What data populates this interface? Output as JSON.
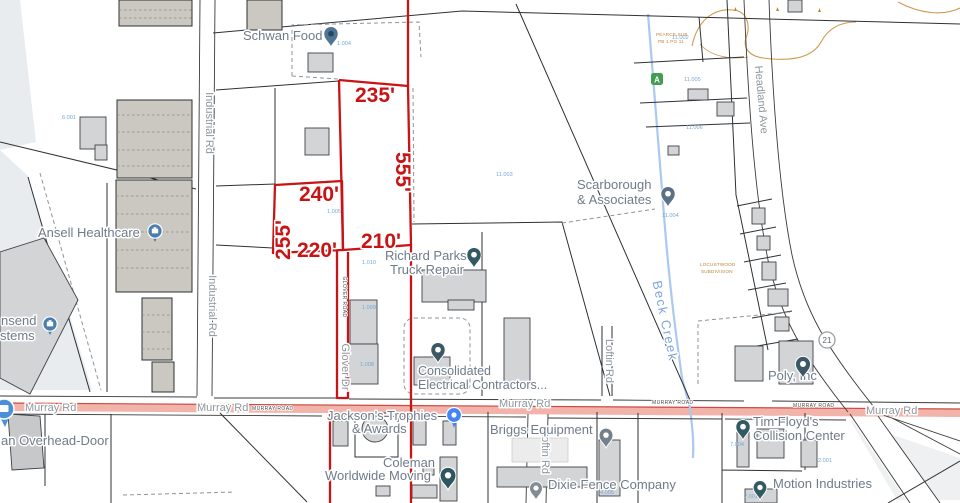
{
  "colors": {
    "survey_red": "#c81414",
    "road_highlight_pink": "#f2b3aa",
    "poi_text_gray": "#6f7b8a",
    "road_text_gray": "#8e969e",
    "creek_blue": "#abc8f0",
    "creek_text_blue": "#7fa6e0",
    "parcel_number_blue": "#74a9d8",
    "subdivision_orange": "#bf8436",
    "building_gray": "#d2d4d6",
    "pin_blue": "#4285f4",
    "pin_slate": "#3c5864"
  },
  "survey_dimensions": {
    "top_width": "235'",
    "east_side": "555'",
    "upper_width": "240'",
    "west_side": "255'",
    "lower_width": "220'",
    "bottom_width": "210'"
  },
  "roads": {
    "murray_rd": "Murray Rd",
    "murray_road_small": "MURRAY ROAD",
    "industrial_rd": "Industrial Rd",
    "headland_ave": "Headland Ave",
    "loftin_rd": "Loftin Rd",
    "glover_dr": "Glover Dr",
    "glover_road_small": "GLOVER ROAD",
    "route_shield": "21"
  },
  "water": {
    "beck_creek": "Beck Creek"
  },
  "places": {
    "schwan": "Schwan Food",
    "ansell": "Ansell Healthcare",
    "townsend_line1": "nsend",
    "townsend_line2": "stems",
    "scarborough_line1": "Scarborough",
    "scarborough_line2": "& Associates",
    "richard_line1": "Richard Parks",
    "richard_line2": "Truck Repair",
    "consolidated_line1": "Consolidated",
    "consolidated_line2": "Electrical Contractors...",
    "jackson_line1": "Jackson's Trophies",
    "jackson_line2": "& Awards",
    "briggs": "Briggs Equipment",
    "coleman_line1": "Coleman",
    "coleman_line2": "Worldwide Moving",
    "dixie": "Dixie Fence Company",
    "tim_floyd_line1": "Tim Floyd's",
    "tim_floyd_line2": "Collision Center",
    "motion": "Motion Industries",
    "poly": "Poly, Inc",
    "overhead_door": "an Overhead-Door"
  },
  "parcel_numbers": {
    "n6_001": "6.001",
    "n1_004": "1.004",
    "n1_005": "1.005",
    "n1_008": "1.008",
    "n1_009": "1.009",
    "n1_010": "1.010",
    "n11_002": "11.002",
    "n11_003": "11.003",
    "n11_004": "11.004",
    "n11_005": "11.005",
    "n11_006": "11.006",
    "n2_001": "2.001",
    "n4_005": "4.005",
    "n7_004": "7.004",
    "n7_001": "7.001"
  },
  "subdivisions": {
    "pearce_line1": "PEARCE SUB",
    "pearce_line2": "PB 1 PG 11",
    "locust_line1": "LOCUSTWOOD",
    "locust_line2": "SUBDIVISION"
  },
  "markers": {
    "badge_a": "A"
  }
}
